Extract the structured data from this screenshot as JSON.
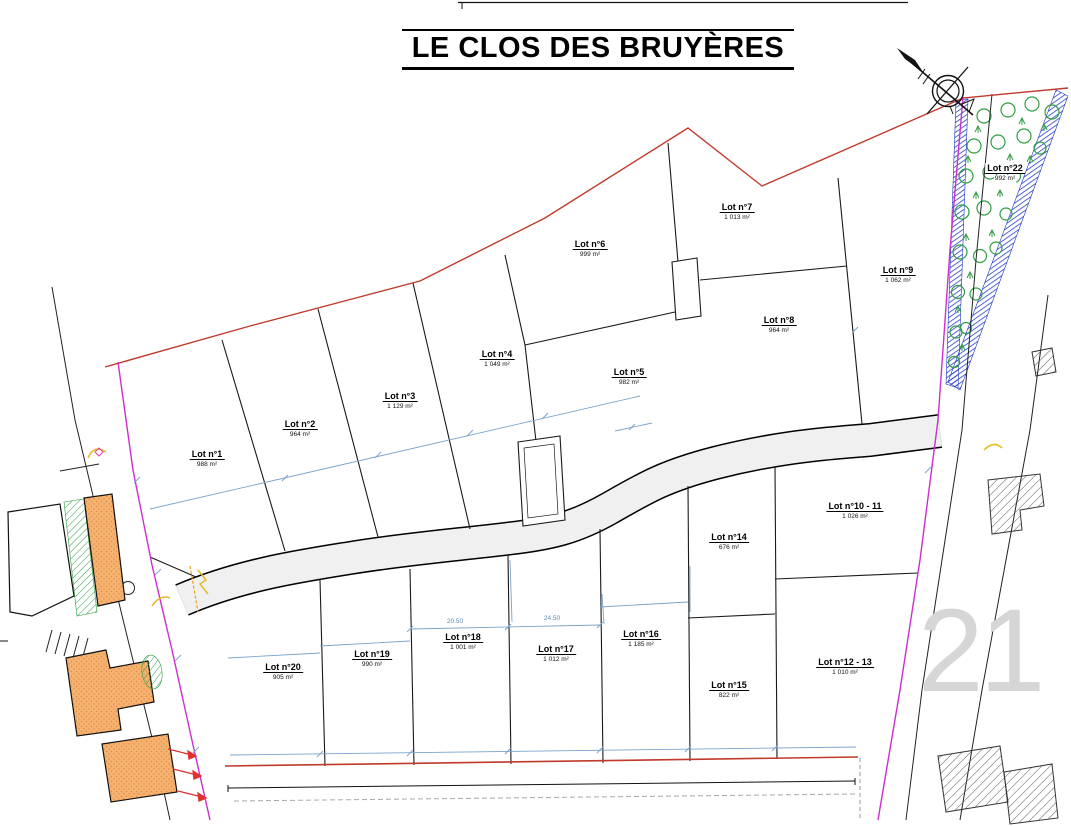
{
  "title": "LE CLOS DES BRUYÈRES",
  "plan": {
    "lots": [
      {
        "name": "Lot n°1",
        "area": "988 m²"
      },
      {
        "name": "Lot n°2",
        "area": "964 m²"
      },
      {
        "name": "Lot n°3",
        "area": "1 129 m²"
      },
      {
        "name": "Lot n°4",
        "area": "1 049 m²"
      },
      {
        "name": "Lot n°5",
        "area": "982 m²"
      },
      {
        "name": "Lot n°6",
        "area": "999 m²"
      },
      {
        "name": "Lot n°7",
        "area": "1 013 m²"
      },
      {
        "name": "Lot n°8",
        "area": "964 m²"
      },
      {
        "name": "Lot n°9",
        "area": "1 062 m²"
      },
      {
        "name": "Lot n°10 - 11",
        "area": "1 026 m²"
      },
      {
        "name": "Lot n°12 - 13",
        "area": "1 010 m²"
      },
      {
        "name": "Lot n°14",
        "area": "676 m²"
      },
      {
        "name": "Lot n°15",
        "area": "822 m²"
      },
      {
        "name": "Lot n°16",
        "area": "1 185 m²"
      },
      {
        "name": "Lot n°17",
        "area": "1 012 m²"
      },
      {
        "name": "Lot n°18",
        "area": "1 001 m²"
      },
      {
        "name": "Lot n°19",
        "area": "990 m²"
      },
      {
        "name": "Lot n°20",
        "area": "905 m²"
      },
      {
        "name": "Lot n°22",
        "area": "992 m²"
      }
    ],
    "dimensions": {
      "d1": "20.50",
      "d2": "24.50"
    },
    "neighbor_parcel_number": "21",
    "colors": {
      "boundary_red": "#c0392b",
      "limit_magenta": "#cc2fcc",
      "dimension_blue": "#7aa3cc",
      "vegetation_green": "#2f9e44",
      "embankment_blue": "#1d35c4",
      "building_orange": "#f6b271",
      "road_grey": "#f0f0f0"
    }
  }
}
